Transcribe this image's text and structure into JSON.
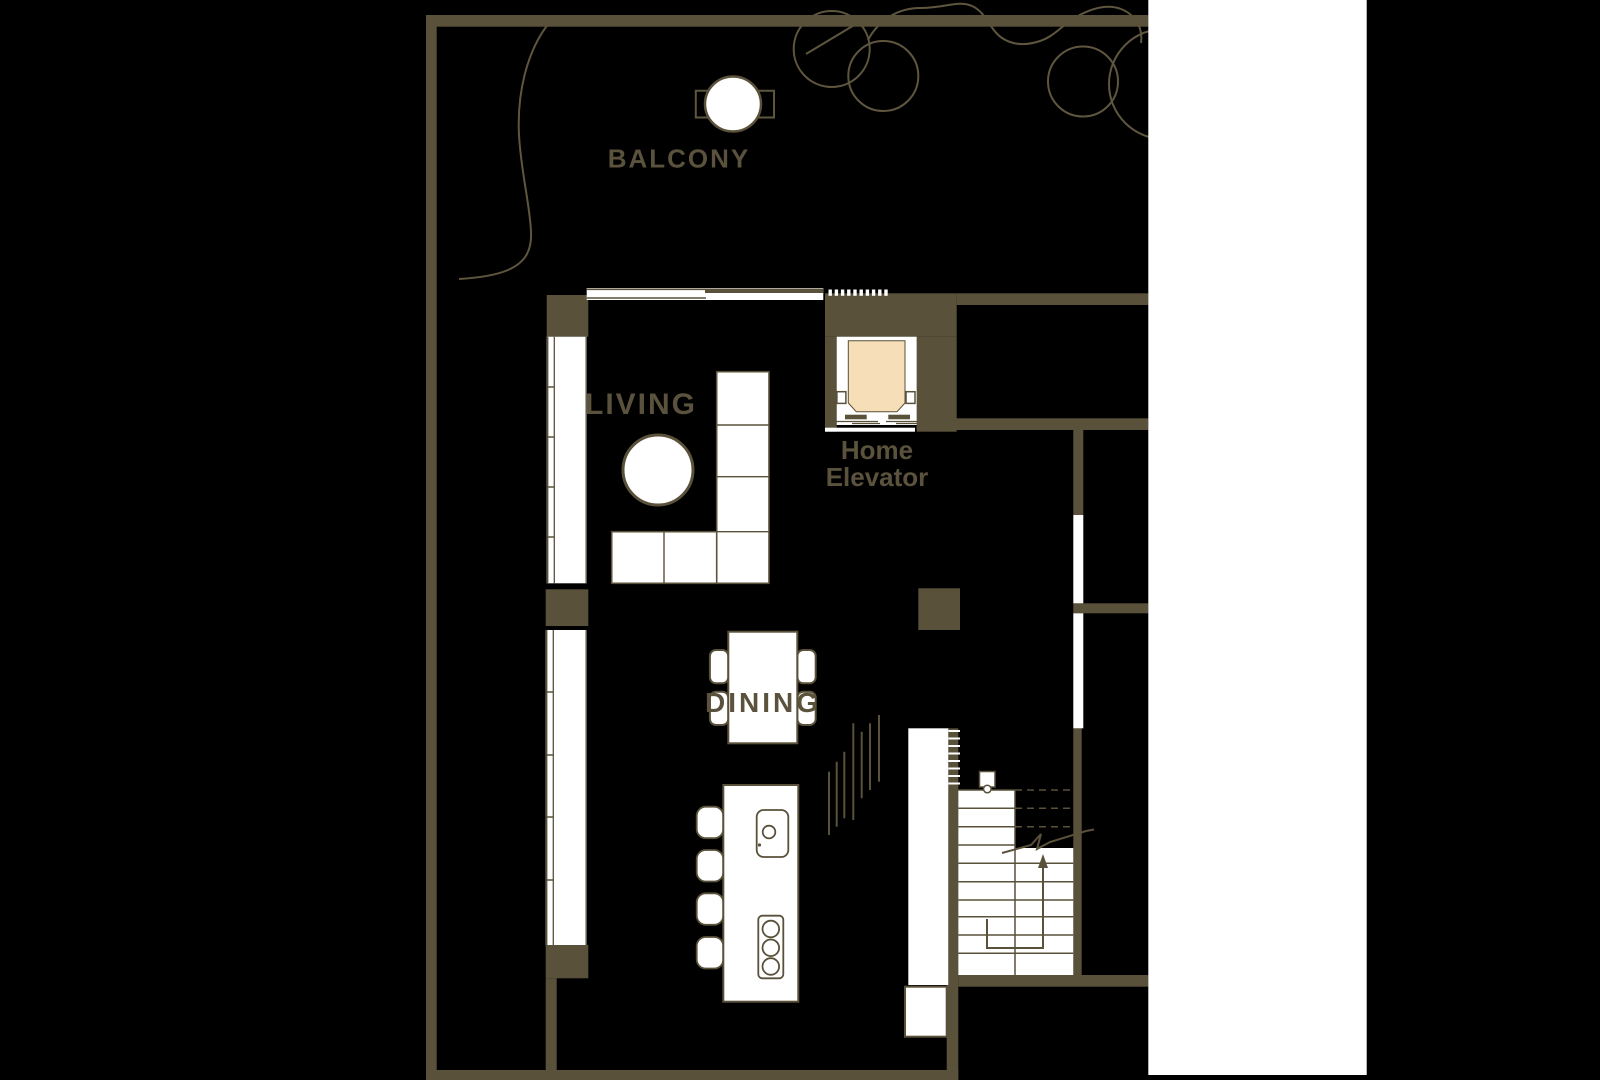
{
  "colors": {
    "background": "#000000",
    "wall": "#59513A",
    "line": "#5E563E",
    "floor_white": "#FFFFFF",
    "elevator_cab": "#F6DFB8",
    "label_text": "#5A523C"
  },
  "labels": {
    "balcony": "BALCONY",
    "living": "LIVING",
    "dining": "DINING",
    "home_elevator_line1": "Home",
    "home_elevator_line2": "Elevator"
  }
}
